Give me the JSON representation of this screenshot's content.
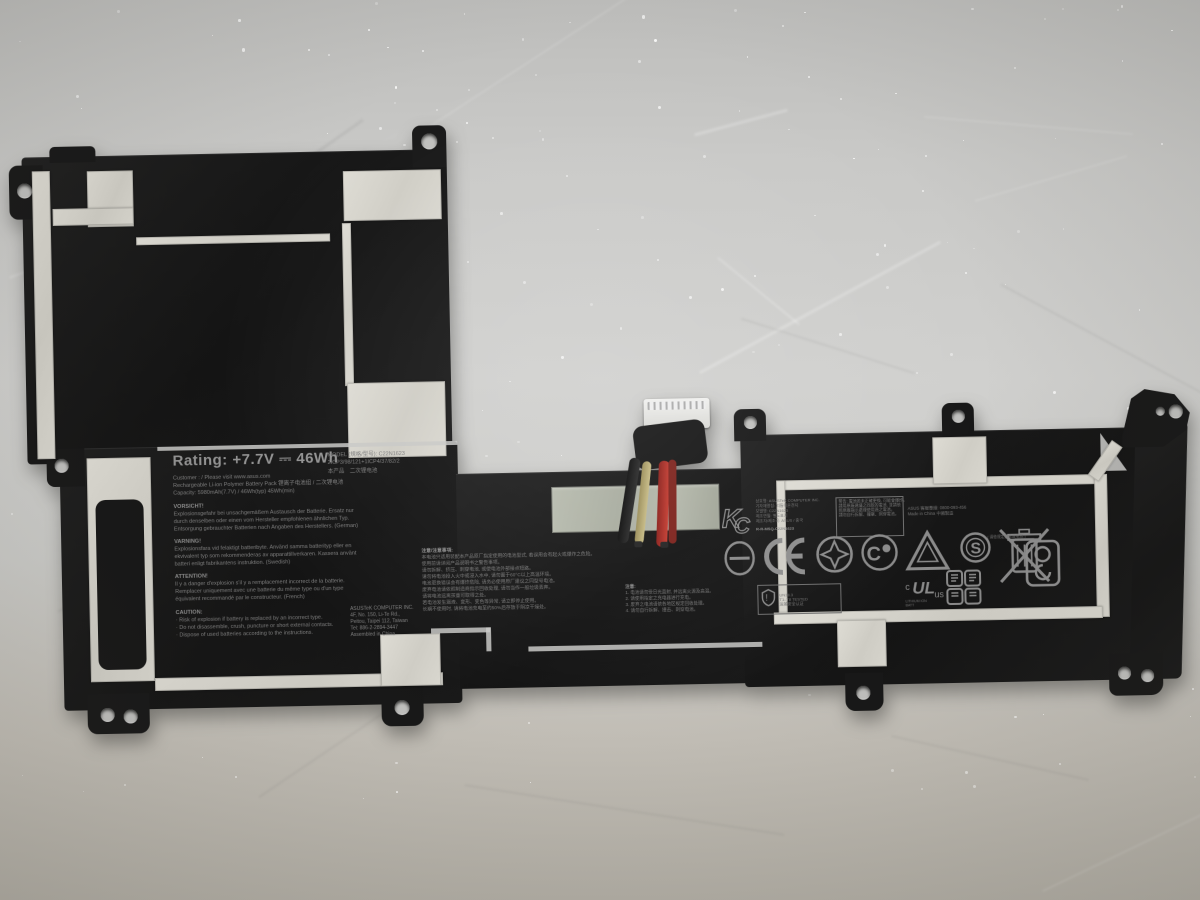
{
  "scene": {
    "description": "Black ASUS laptop battery pack lying on crinkled silver foil background",
    "background_color": "#c9c9c7",
    "battery_color": "#161616",
    "tape_color": "#d7d5cd",
    "wire_colors": {
      "red": "#b03028",
      "black": "#1c1c1c",
      "khaki": "#b5a86f",
      "white": "#dcdcd8"
    }
  },
  "label": {
    "rating": "Rating: +7.7V ⎓ 46Wh",
    "line_customer": "Customer :        / Please visit www.asus.com",
    "line_pack": "Rechargeable Li-ion Polymer Battery Pack   锂离子电池组 / 二次锂电池",
    "line_capacity": "Capacity: 5980mAh(7.7V) / 46Wh(typ) 45Wh(min)",
    "de_title": "VORSICHT!",
    "de_lines": {
      "0": "Explosionsgefahr bei unsachgemäßem Austausch der Batterie. Ersatz nur",
      "1": "durch denselben oder einen vom Hersteller empfohlenen ähnlichen Typ.",
      "2": "Entsorgung gebrauchter Batterien nach Angaben des Herstellers. (German)"
    },
    "sv_title": "VARNING!",
    "sv_lines": {
      "0": "Explosionsfara vid felaktigt batteribyte. Använd samma batterityp eller en",
      "1": "ekvivalent typ som rekommenderas av apparattillverkaren. Kassera använt",
      "2": "batteri enligt fabrikantens instruktion. (Swedish)"
    },
    "fr_title": "ATTENTION!",
    "fr_lines": {
      "0": "Il y a danger d'explosion s'il y a remplacement incorrect de la batterie.",
      "1": "Remplacer uniquement avec une batterie du même type ou d'un type",
      "2": "équivalent recommandé par le constructeur. (French)"
    },
    "caution_title": "CAUTION:",
    "caution_lines": {
      "0": "· Risk of explosion if battery is replaced by an incorrect type.",
      "1": "· Do not disassemble, crush, puncture or short external contacts.",
      "2": "· Dispose of used batteries according to the instructions."
    },
    "maker_lines": {
      "0": "ASUSTeK COMPUTER INC.",
      "1": "4F, No. 150, Li-Te Rd.,",
      "2": "Peitou, Taipei 112, Taiwan",
      "3": "Tel: 886-2-2894-3447",
      "4": "Assembled in China"
    }
  },
  "model_block": {
    "model_line": "MODEL (規格/型号): C22N1623",
    "cell_line": "2ICP3/98/121+1ICP4/37/82/2",
    "type_line": "本产品　二次锂电池"
  },
  "cn_warning": {
    "title": "注意/注意事項:",
    "lines": {
      "0": "本电池只适用装配本产品原厂指定使用的电池型式, 若误用会有起火或爆炸之危险。",
      "1": "使用前请详阅产品说明书之警告事项。",
      "2": "请勿拆解、挤压、刺穿电池, 或使电池外部接点短路。",
      "3": "请勿将电池投入火中或浸入水中, 请勿置于60°C以上高温环境。",
      "4": "电池更换错误会有爆炸危险, 请务必使用原厂建议之同型号电池。",
      "5": "废弃电池请依照制造商指示回收处理, 请勿当作一般垃圾丢弃。",
      "6": "请将电池远离孩童可取得之处。",
      "7": "若电池发生漏液、变形、变色等异常, 请立即停止使用。",
      "8": "长期不使用时, 请将电池充电至约50%后存放于阴凉干燥处。"
    }
  },
  "numbered_note": {
    "title": "注意:",
    "lines": {
      "0": "1. 电池请勿受日光直射, 并远离火源及高温。",
      "1": "2. 请使用指定之充电器进行充电。",
      "2": "3. 废弃之电池请依各地区规定回收处理。",
      "3": "4. 请勿自行拆解、撞击、刺穿电池。"
    }
  },
  "kc_block": {
    "mark": "KC",
    "lines": {
      "0": "상호명: ASUSTeK COMPUTER INC.",
      "1": "기자재명칭: 리튬이온전지",
      "2": "모델명: C22N1623",
      "3": "제조연월: 별도표기",
      "4": "제조자/제조국: ASUS / 중국"
    },
    "reg_line": "R-R-MSQ-C22N1623"
  },
  "cn_box": {
    "lines": {
      "0": "警告: 電池若未正確更換, 可能會爆炸。",
      "1": "請用原廠建議之同款的電池, 並請依",
      "2": "照原廠指示處理使用過之電池。",
      "3": "請勿自行拆解、撞擊、刺穿電池。"
    }
  },
  "box_right_lines": {
    "0": "ASUS 客服專線: 0800-093-456",
    "1": "Made in China 中國製造"
  },
  "shield_box": {
    "lines": {
      "0": "UN38.3",
      "1": "T1–T8 TESTED",
      "2": "运输安全认证"
    }
  },
  "recycle_note": "( 请依规定回收废电池 )",
  "ul_caption": {
    "0": "LITHIUM ION",
    "1": "BATT"
  },
  "marks": {
    "ce": "CE",
    "circled_s": "S",
    "ul": "UL",
    "kc": "KC"
  }
}
